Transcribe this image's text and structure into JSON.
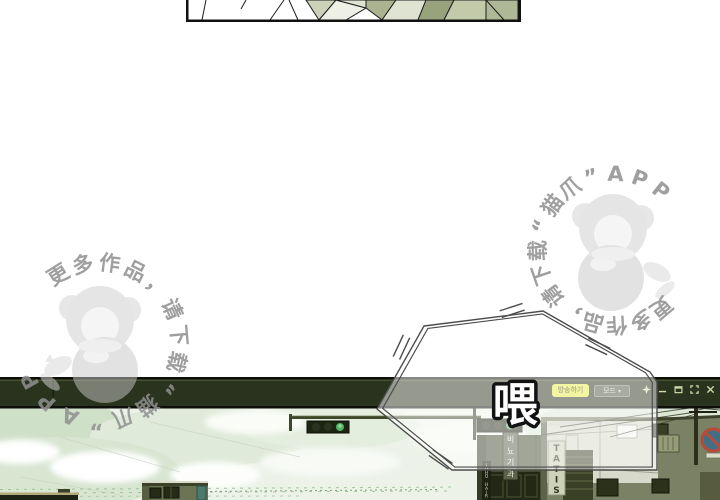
{
  "watermark": {
    "text": "更多作品，请下载“猫爪”APP",
    "color": "#8f8f8f"
  },
  "speech_bubble": {
    "text": "喂"
  },
  "stream_window": {
    "titlebar": {
      "broadcast_button": "방송하기",
      "mode_button": "모드",
      "mode_arrow": "▾",
      "controls": [
        "pin",
        "minimize",
        "restore",
        "maximize",
        "close"
      ]
    },
    "scene_signs": {
      "urology": "비뇨기과",
      "hair": "JUHO HAIR",
      "tatis": "TATIS"
    },
    "colors": {
      "titlebar": "#2a331d",
      "accent_yellow": "#e9ea45",
      "sky": "#edf2e9",
      "building_olive": "#7b8165",
      "traffic_green": "#4fb266",
      "sign_red": "#b44b3c",
      "sign_blue": "#417086"
    }
  }
}
